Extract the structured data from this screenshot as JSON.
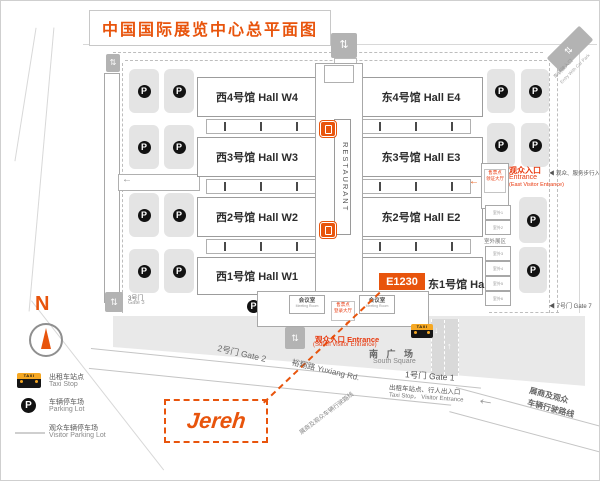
{
  "title": "中国国际展览中心总平面图",
  "badge": "E1230",
  "logo_text": "Jereh",
  "glyphs": {
    "p": "P",
    "taxi": "TAXI",
    "n": "N",
    "updown": "⇅",
    "up": "↑",
    "down": "↓",
    "left": "←",
    "left_small": "◀"
  },
  "halls": {
    "west": [
      {
        "label": "西4号馆 Hall W4"
      },
      {
        "label": "西3号馆 Hall W3"
      },
      {
        "label": "西2号馆 Hall W2"
      },
      {
        "label": "西1号馆 Hall W1"
      }
    ],
    "east": [
      {
        "label": "东4号馆 Hall E4"
      },
      {
        "label": "东3号馆 Hall E3"
      },
      {
        "label": "东2号馆 Hall E2"
      },
      {
        "label": "东1号馆 Hall E1"
      }
    ]
  },
  "center": {
    "restaurant": "RESTAURANT"
  },
  "rooms": {
    "meeting_zh": "会议室",
    "meeting_en": "Meeting Room",
    "south_box_line1": "售票点",
    "south_box_line2": "登录大厅",
    "east_box_line1": "售票点",
    "east_box_line2": "领证大厅"
  },
  "entrances": {
    "east_zh": "观众入口",
    "east_en": "Entrance",
    "east_en2": "(East Visitor Entrance)",
    "south_line1": "观众入口 Entrance",
    "south_line2": "(South Visitor Entrance)",
    "top_car_zh": "车辆驶入口",
    "top_car_en": "Entry With Car Park",
    "corner_car_zh": "车辆驶入口",
    "corner_car_en": "Entry With Car Park",
    "walk_right": "◀ 观众、服务步行入口"
  },
  "gates": {
    "g1": "1号门 Gate 1",
    "g2": "2号门 Gate 2",
    "g3_zh": "3号门",
    "g3_en": "Gate 3",
    "g7": "◀ 7号门 Gate 7"
  },
  "south": {
    "square_zh": "南 广 场",
    "square_en": "South Square",
    "taxi_zh": "出租车站点、行人出入口",
    "taxi_en": "Taxi Stop，  Visitor Entrance",
    "route_right_1": "展商及观众",
    "route_right_2": "车辆行驶路线",
    "route_left": "展商及观众车辆行驶路线",
    "road": "裕翔路  Yuxiang Rd."
  },
  "outdoor": {
    "label": "室外展区",
    "boxes": [
      "室外1",
      "室外2",
      "室外3",
      "室外4",
      "室外5",
      "室外6"
    ]
  },
  "legend": {
    "taxi_zh": "出租车站点",
    "taxi_en": "Taxi Stop",
    "parking_zh": "车辆停车场",
    "parking_en": "Parking Lot",
    "visitor_zh": "观众车辆停车场",
    "visitor_en": "Visitor Parking Lot"
  },
  "colors": {
    "accent": "#e8540c",
    "red": "#e8380d"
  }
}
